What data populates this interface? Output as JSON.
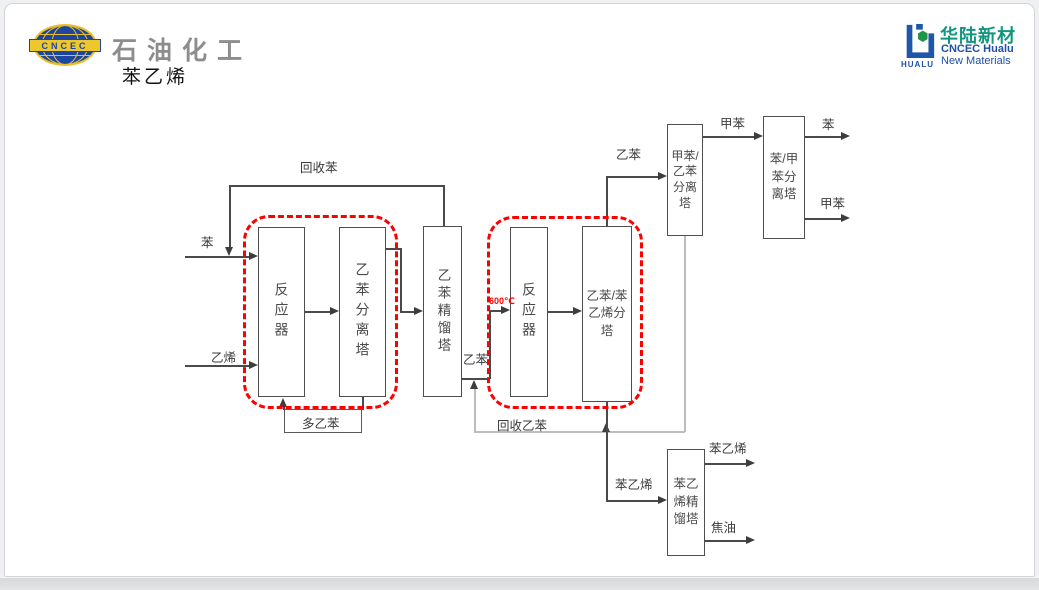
{
  "slide": {
    "header": {
      "cncec_logo_text": "CNCEC",
      "brand_name": "石油化工",
      "page_title": "苯乙烯"
    },
    "hualu_logo": {
      "wordmark": "HUALU",
      "name_cn": "华陆新材",
      "name_en_line1": "CNCEC Hualu",
      "name_en_line2": "New Materials"
    }
  },
  "diagram": {
    "boxes": [
      {
        "id": "reactor-1",
        "label": "反应器"
      },
      {
        "id": "eb-separation-column",
        "label": "乙苯分离塔"
      },
      {
        "id": "eb-distillation-column",
        "label": "乙苯精馏塔"
      },
      {
        "id": "reactor-2",
        "label": "反应器"
      },
      {
        "id": "eb-sm-splitter-column",
        "label": "乙苯/苯\n乙烯分\n塔"
      },
      {
        "id": "toluene-eb-separation-column",
        "label": "甲苯/\n乙苯\n分离\n塔"
      },
      {
        "id": "benzene-toluene-separation-column",
        "label": "苯/甲\n苯分\n离塔"
      },
      {
        "id": "sm-distillation-column",
        "label": "苯乙\n烯精\n馏塔"
      }
    ],
    "streams": [
      {
        "id": "recycle-benzene",
        "label": "回收苯"
      },
      {
        "id": "benzene-feed",
        "label": "苯"
      },
      {
        "id": "ethylene-feed",
        "label": "乙烯"
      },
      {
        "id": "poly-ethylbenzene",
        "label": "多乙苯"
      },
      {
        "id": "ethylbenzene-to-reactor2",
        "label": "乙苯"
      },
      {
        "id": "recycle-ethylbenzene",
        "label": "回收乙苯"
      },
      {
        "id": "ethylbenzene-overhead",
        "label": "乙苯"
      },
      {
        "id": "toluene-intermediate",
        "label": "甲苯"
      },
      {
        "id": "benzene-product",
        "label": "苯"
      },
      {
        "id": "toluene-product",
        "label": "甲苯"
      },
      {
        "id": "styrene-to-column",
        "label": "苯乙烯"
      },
      {
        "id": "styrene-product",
        "label": "苯乙烯"
      },
      {
        "id": "tar-product",
        "label": "焦油"
      }
    ],
    "annotations": {
      "reactor2_temperature": "600℃"
    },
    "colors": {
      "line": "#4a4a4a",
      "recycle_line": "#bdbdbd",
      "highlight_red": "#ff0000",
      "brand_blue": "#1e4fa8",
      "brand_teal": "#13967e",
      "brand_yellow": "#eec62d"
    }
  }
}
